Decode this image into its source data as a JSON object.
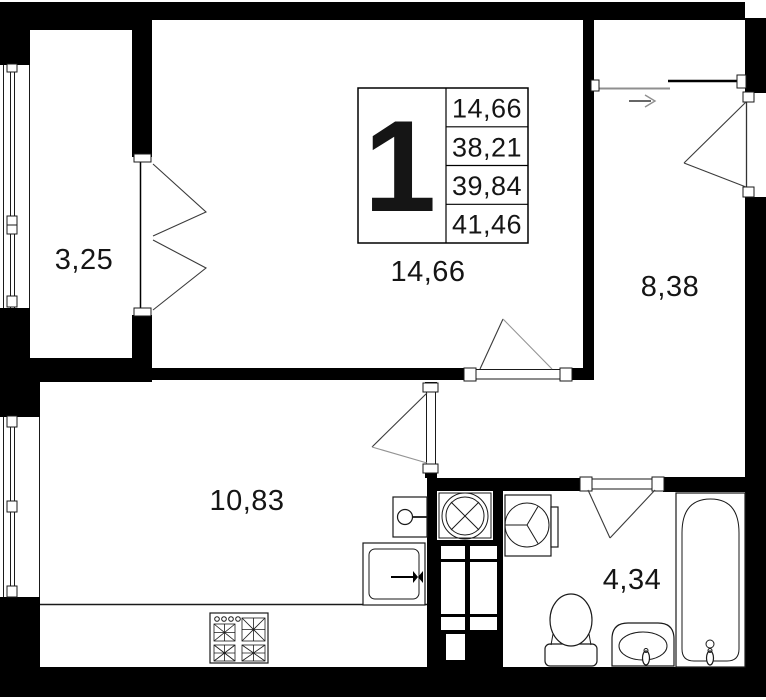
{
  "unit_card": {
    "big_number": "1",
    "area_rows": [
      "14,66",
      "38,21",
      "39,84",
      "41,46"
    ]
  },
  "room_labels": {
    "loggia": "3,25",
    "living_room": "14,66",
    "hallway": "8,38",
    "kitchen_living": "10,83",
    "bathroom": "4,34"
  },
  "colors": {
    "walls": "#000000",
    "background": "#ffffff",
    "door_swing_gray": "#8f8f8f"
  }
}
